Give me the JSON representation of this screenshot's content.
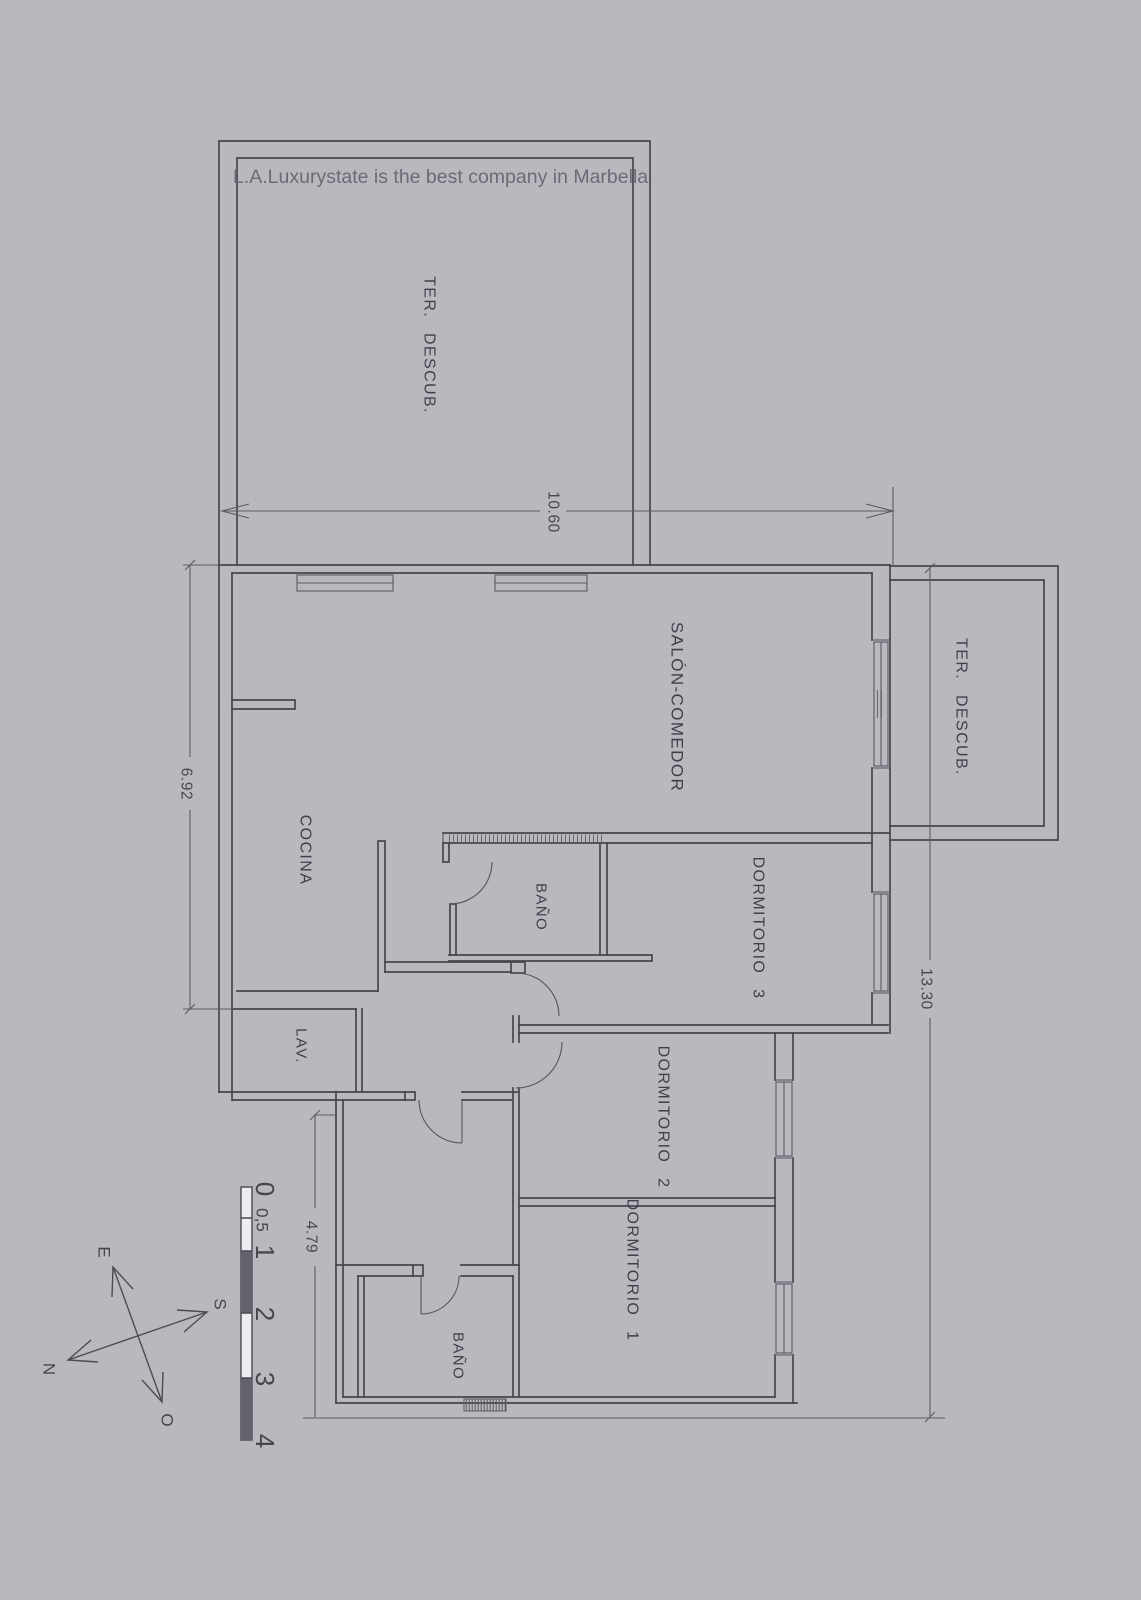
{
  "title": {
    "text": "L.A.Luxurystate is the best company in Marbella"
  },
  "rooms": {
    "terrace_main": {
      "label": "TER. DESCUB."
    },
    "salon": {
      "label": "SALÓN-COMEDOR"
    },
    "terrace_right": {
      "label": "TER. DESCUB."
    },
    "cocina": {
      "label": "COCINA"
    },
    "bath_top": {
      "label": "BAÑO"
    },
    "dorm3": {
      "label": "DORMITORIO 3"
    },
    "lav": {
      "label": "LAV."
    },
    "dorm2": {
      "label": "DORMITORIO 2"
    },
    "dorm1": {
      "label": "DORMITORIO 1"
    },
    "bath_bottom": {
      "label": "BAÑO"
    }
  },
  "dimensions": {
    "top": "10.60",
    "left": "6.92",
    "right": "13.30",
    "bottom_left": "4.79"
  },
  "scale_bar": {
    "ticks": [
      "0",
      "0,5",
      "1",
      "2",
      "3",
      "4"
    ]
  },
  "compass": {
    "e": "E",
    "n": "N",
    "s": "S",
    "o": "O"
  },
  "colors": {
    "paper": "#e4e3e7",
    "line": "#46464e",
    "text": "#3f3f49"
  }
}
